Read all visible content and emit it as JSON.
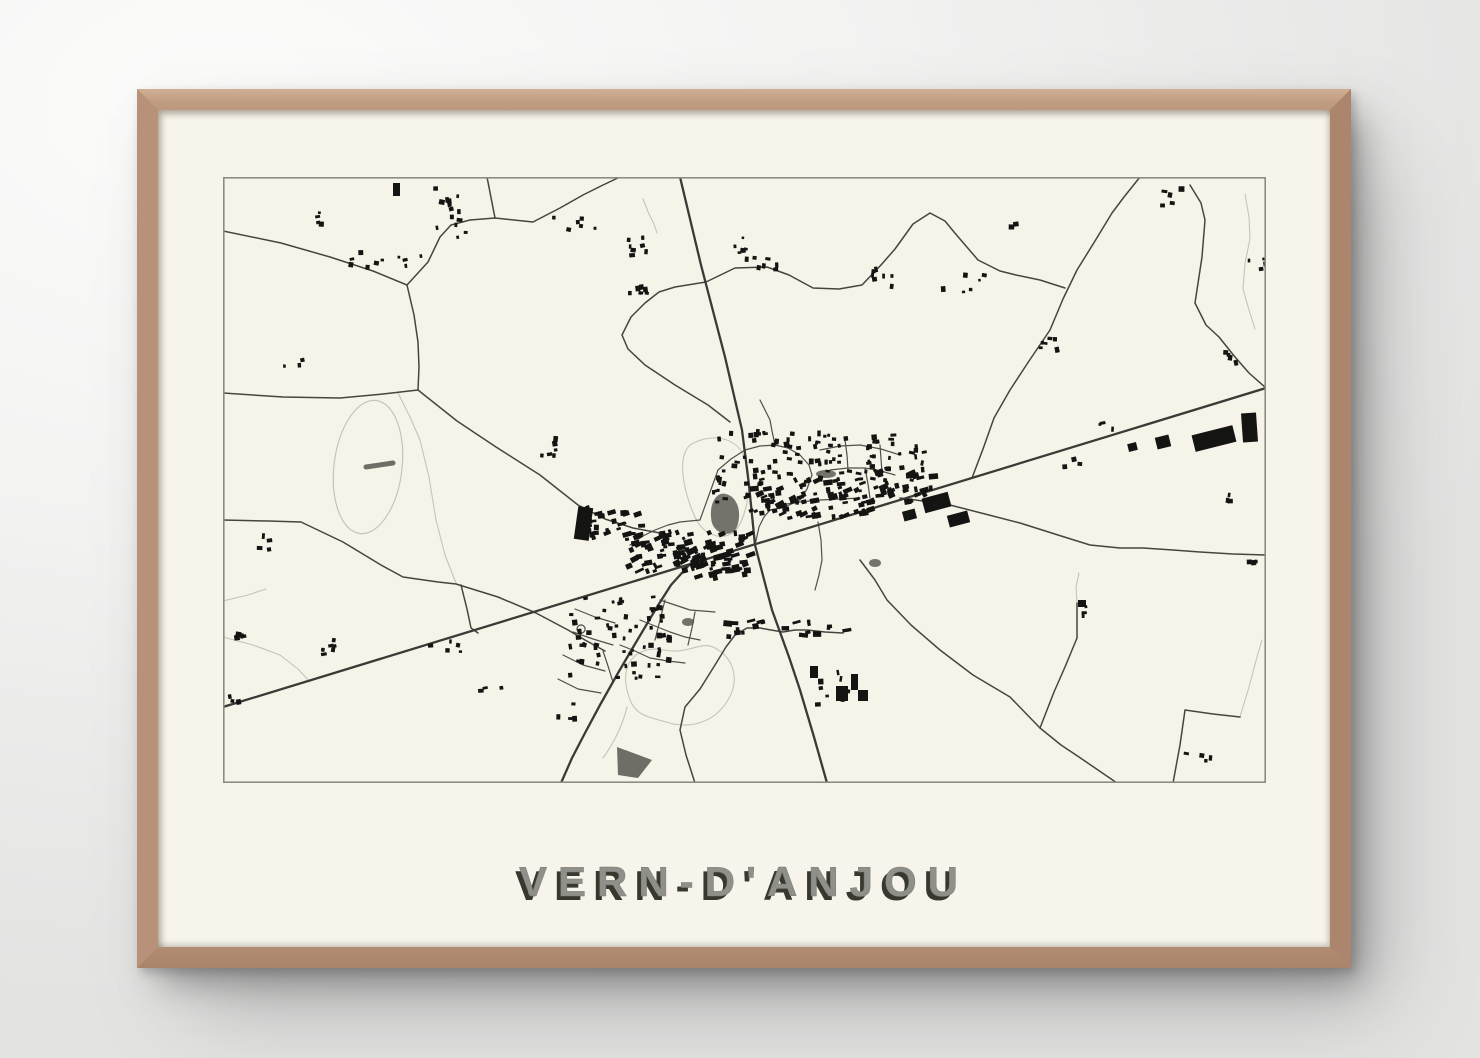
{
  "poster": {
    "title": "VERN-D'ANJOU"
  },
  "map": {
    "colors": {
      "paper": "#f6f4e9",
      "border": "#8c8c84",
      "road_major": "#3a3a36",
      "road_minor": "#45453f",
      "street": "#50504a",
      "light_path": "#c6c4b8",
      "building": "#141412",
      "water": "#73736c",
      "field": "#6e6e67"
    },
    "roads_major": [
      "M0,530 L1043,211",
      "M457,0 L478,88 L502,180 L519,253 L526,308 L532,368",
      "M532,368 L549,433 L566,480 L577,513 L591,560 L604,606",
      "M467,387 L448,408 L434,430 L412,467 L395,496 L377,528 L362,556 L349,581 L338,606"
    ],
    "roads_minor": [
      "M0,54 L58,66 L107,80 L150,94 L184,108",
      "M184,108 L205,85 L217,60 L228,48 L247,43",
      "M264,0 L272,41",
      "M247,43 L272,41 L310,45 L337,31 L360,18 L380,8 L397,0",
      "M184,108 L191,138 L195,165 L196,190 L195,213",
      "M0,216 L60,220 L117,221 L160,217 L195,213",
      "M195,213 L234,244 L273,270 L317,298 L355,328 L382,342 L410,351 L437,356",
      "M0,343 L45,344 L78,345 L120,365 L158,388 L180,400 L215,405 L233,407 L275,420 L313,436 L345,453 L362,463 L382,474",
      "M238,408 L244,432 L248,451 L255,456",
      "M483,105 L452,110 L436,115 L422,126 L408,140 L399,158 L405,172 L422,188 L452,208 L485,228 L507,245",
      "M483,105 L512,91 L544,90 L566,98 L590,111 L616,112 L639,108 L658,88 L672,72 L690,47 L707,36 L722,44 L731,55 L755,83 L777,94 L793,98 L817,103 L842,111",
      "M917,0 L901,20 L889,36 L872,64 L854,93 L840,122 L827,153 L806,184 L787,213 L771,241 L760,272 L749,301",
      "M967,8 L978,26 L982,43 L979,80 L972,126 L983,148 L996,160 L1012,180 L1026,196 L1043,211",
      "M677,321 L700,324 L727,328 L762,337 L797,346 L835,358 L867,368 L897,371 L920,371 L950,373 L977,375 L1010,377 L1043,378",
      "M637,383 L652,403 L664,423 L688,448 L717,473 L750,498 L787,520 L817,551 L838,568 L856,580 L875,593 L894,606",
      "M817,551 L831,515 L842,490 L854,461 L854,426",
      "M950,606 L957,568 L962,533 L990,537 L1017,540",
      "M472,606 L463,578 L457,553 L462,530 L477,512 L492,488 L503,470 L512,458 L524,451 L537,451 L548,453 L560,455 L572,453 L584,453 L602,455 L620,456"
    ],
    "streets": [
      "M495,293 L508,282 L522,273 L537,269 L552,268 L565,271 L577,278 L586,288 L589,298 L584,312 L577,323 L562,330 L547,333",
      "M552,268 L549,254 L547,243 L541,231 L537,223",
      "M597,273 L617,269 L637,268 L658,272 L677,278",
      "M607,293 L625,291 L642,291 L658,294 L672,298",
      "M622,263 L624,278 L625,293",
      "M657,268 L658,282 L659,295",
      "M407,368 L420,359 L432,353 L445,348 L457,345 L477,343",
      "M437,423 L452,428 L467,433 L480,434 L492,435",
      "M417,443 L432,449 L447,455 L462,460 L477,463",
      "M397,468 L412,474 L427,481 L445,484 L462,486",
      "M442,423 L437,443 L432,463",
      "M472,435 L469,451 L465,468",
      "M557,328 L577,325 L597,323 L617,322 L637,321",
      "M595,345 L598,363 L599,383 L596,398 L592,413",
      "M477,343 L486,318 L495,293",
      "M532,368 L536,350 L541,340 L547,333",
      "M380,474 L385,489 L390,505",
      "M350,455 L370,462 L390,468",
      "M340,478 L360,488 L382,494",
      "M335,502 L355,512 L378,516",
      "M352,432 L372,440 L392,446",
      "M642,291 L645,307 L647,321",
      "M358,448 a4,4 0 1,0 0.1,0"
    ],
    "light_paths": [
      "M175,216 L187,240 L197,263 L206,300 L213,343 L222,378 L233,406",
      "M467,268 C487,256 512,259 521,279 C529,296 527,326 517,347 C508,366 483,362 473,342 C463,322 452,282 467,268 Z",
      "M404,513 C397,483 417,468 441,473 C466,478 477,463 492,471 C511,481 517,503 505,523 C492,545 467,553 443,545 C418,538 410,537 404,513 Z",
      "M404,530 C399,551 390,567 380,581",
      "M0,424 L25,418 L43,412",
      "M0,460 L30,468 L57,478 L75,492 L87,505",
      "M420,22 L426,37 L431,47 L434,56",
      "M1022,17 L1026,40 L1027,62 L1022,86 L1020,112 L1026,133 L1032,152",
      "M1017,540 L1026,510 L1034,480 L1039,463",
      "M854,426 L853,410 L856,396"
    ],
    "track": {
      "cx": 145,
      "cy": 290,
      "rx": 34,
      "ry": 67,
      "angle": 7,
      "bar": "M143,290 L170,286"
    },
    "ponds": [
      "M489,346 C485,330 492,314 503,317 C515,320 519,336 514,350 C509,361 493,358 489,346 Z"
    ],
    "pond_ellipses": [
      [
        603,
        297,
        10,
        4
      ],
      [
        465,
        445,
        6,
        4
      ],
      [
        652,
        386,
        6,
        4
      ]
    ],
    "field_shapes": [
      "M394,570 L429,583 L415,601 L395,598 Z"
    ],
    "building_clusters": [
      [
        398,
        352,
        128,
        46,
        120,
        -17
      ],
      [
        520,
        298,
        125,
        42,
        75,
        -17
      ],
      [
        645,
        292,
        62,
        32,
        26,
        -17
      ],
      [
        352,
        328,
        68,
        36,
        30,
        -10
      ],
      [
        488,
        252,
        118,
        72,
        72,
        0
      ],
      [
        602,
        256,
        98,
        46,
        46,
        0
      ],
      [
        338,
        412,
        108,
        88,
        62,
        0
      ],
      [
        500,
        442,
        122,
        16,
        20,
        -5
      ],
      [
        583,
        486,
        58,
        42,
        8,
        0
      ],
      [
        210,
        8,
        36,
        56,
        14,
        0
      ],
      [
        122,
        68,
        80,
        20,
        10,
        0
      ],
      [
        327,
        38,
        44,
        16,
        6,
        0
      ],
      [
        403,
        58,
        24,
        20,
        7,
        0
      ],
      [
        403,
        104,
        22,
        16,
        7,
        0
      ],
      [
        510,
        52,
        20,
        32,
        8,
        0
      ],
      [
        533,
        80,
        20,
        12,
        5,
        0
      ],
      [
        643,
        86,
        26,
        30,
        7,
        0
      ],
      [
        313,
        256,
        20,
        26,
        6,
        0
      ],
      [
        700,
        86,
        62,
        28,
        6,
        0
      ],
      [
        802,
        152,
        30,
        20,
        6,
        0
      ],
      [
        1013,
        80,
        28,
        12,
        4,
        0
      ],
      [
        996,
        172,
        22,
        16,
        4,
        0
      ],
      [
        996,
        312,
        18,
        12,
        3,
        0
      ],
      [
        1016,
        376,
        16,
        10,
        3,
        0
      ],
      [
        8,
        452,
        22,
        14,
        5,
        0
      ],
      [
        72,
        460,
        40,
        16,
        6,
        0
      ],
      [
        4,
        516,
        16,
        10,
        3,
        0
      ],
      [
        200,
        462,
        44,
        12,
        5,
        0
      ],
      [
        253,
        506,
        24,
        10,
        3,
        0
      ],
      [
        333,
        522,
        26,
        26,
        4,
        0
      ],
      [
        858,
        426,
        18,
        14,
        3,
        0
      ],
      [
        958,
        570,
        28,
        16,
        4,
        0
      ],
      [
        835,
        276,
        24,
        14,
        3,
        0
      ],
      [
        873,
        241,
        22,
        12,
        3,
        0
      ],
      [
        937,
        8,
        48,
        26,
        5,
        0
      ],
      [
        773,
        38,
        18,
        10,
        2,
        0
      ],
      [
        75,
        34,
        22,
        12,
        4,
        0
      ],
      [
        26,
        356,
        22,
        16,
        4,
        0
      ],
      [
        60,
        181,
        18,
        12,
        3,
        0
      ]
    ],
    "large_buildings": [
      [
        353,
        330,
        15,
        33,
        8
      ],
      [
        700,
        318,
        27,
        15,
        -15
      ],
      [
        725,
        336,
        21,
        12,
        -15
      ],
      [
        680,
        333,
        13,
        10,
        -15
      ],
      [
        970,
        253,
        42,
        17,
        -14
      ],
      [
        1019,
        236,
        15,
        29,
        -4
      ],
      [
        933,
        259,
        14,
        12,
        -14
      ],
      [
        905,
        266,
        9,
        8,
        -14
      ],
      [
        613,
        509,
        12,
        15,
        0
      ],
      [
        628,
        497,
        7,
        16,
        0
      ],
      [
        635,
        513,
        10,
        11,
        0
      ],
      [
        587,
        489,
        8,
        12,
        0
      ],
      [
        170,
        6,
        7,
        13,
        0
      ],
      [
        855,
        423,
        8,
        7,
        0
      ]
    ]
  }
}
